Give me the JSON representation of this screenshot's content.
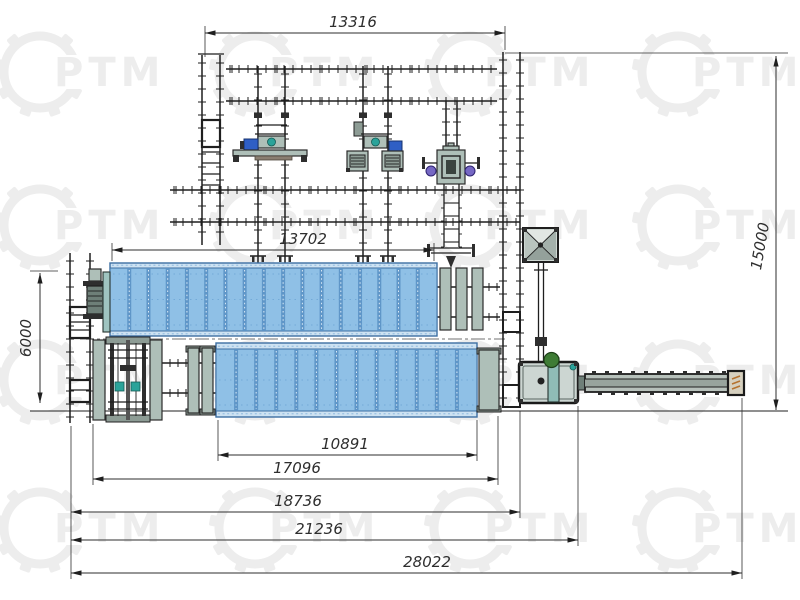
{
  "watermark": {
    "text": "РТМ",
    "gear_color": "#ededed",
    "text_color": "#e9e9e9"
  },
  "dimensions": {
    "top_span": "13316",
    "drum1_length": "13702",
    "left_height": "6000",
    "right_height": "15000",
    "len_10891": "10891",
    "len_17096": "17096",
    "len_18736": "18736",
    "len_21236": "21236",
    "overall_28022": "28022"
  },
  "drums": {
    "drum1_ribs": 17,
    "drum2_ribs": 13
  },
  "colors": {
    "line": "#1f1f1f",
    "dim": "#2e2e2e",
    "drum_border": "#3d6fa3",
    "drum_fill": "#8fc0e6",
    "drum_band": "#cde2f2",
    "drum_rib": "#5b93c6",
    "machine_gray": "#aebfb8",
    "machine_gray_dark": "#8d9c95",
    "teal": "#2ba39a",
    "motor_blue": "#2f5fc5",
    "motor_purple": "#7668c4",
    "fan_green": "#3e7c35",
    "hatch_orange": "#b5722e",
    "watermark": "#ededed"
  }
}
